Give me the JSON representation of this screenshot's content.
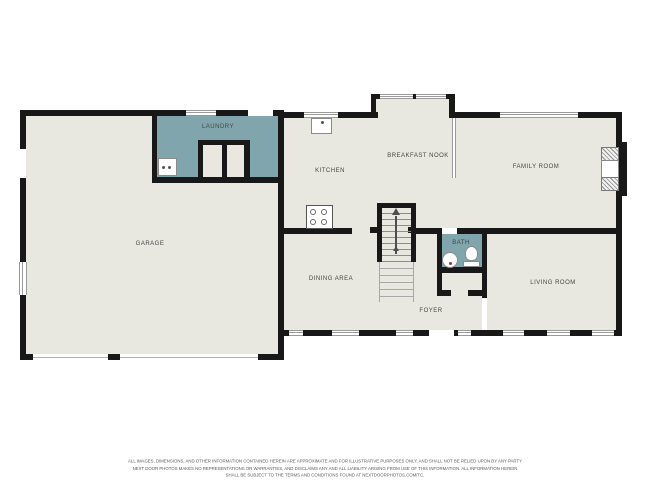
{
  "plan": {
    "rooms": {
      "garage": {
        "label": "GARAGE"
      },
      "laundry": {
        "label": "LAUNDRY"
      },
      "kitchen": {
        "label": "KITCHEN"
      },
      "breakfast_nook": {
        "label": "BREAKFAST NOOK"
      },
      "family_room": {
        "label": "FAMILY ROOM"
      },
      "dining_area": {
        "label": "DINING AREA"
      },
      "bath": {
        "label": "BATH"
      },
      "foyer": {
        "label": "FOYER"
      },
      "living_room": {
        "label": "LIVING ROOM"
      }
    },
    "stairs": {
      "direction": "up"
    },
    "fixtures": [
      "washer",
      "kitchen-sink",
      "stove",
      "bath-sink",
      "toilet",
      "fireplace"
    ]
  },
  "colors": {
    "floor": "#e9e8e0",
    "accent": "#80a5ad",
    "wall": "#181818",
    "winline": "#9a9a9a",
    "label": "#454545"
  },
  "footer": {
    "line1": "ALL IMAGES, DIMENSIONS, AND OTHER INFORMATION CONTAINED HEREIN ARE APPROXIMATE AND FOR ILLUSTRATIVE PURPOSES ONLY, AND SHALL NOT BE RELIED UPON BY ANY PARTY",
    "line2": "NEXT DOOR PHOTOS MAKES NO REPRESENTATIONS OR WARRANTIES, AND DISCLAIMS ANY AND ALL LIABILITY ARISING FROM USE OF THIS INFORMATION. ALL INFORMATION HEREIN",
    "line3": "SHALL BE SUBJECT TO THE TERMS AND CONDITIONS FOUND AT NEXTDOORPHOTOS.COM/TC."
  }
}
